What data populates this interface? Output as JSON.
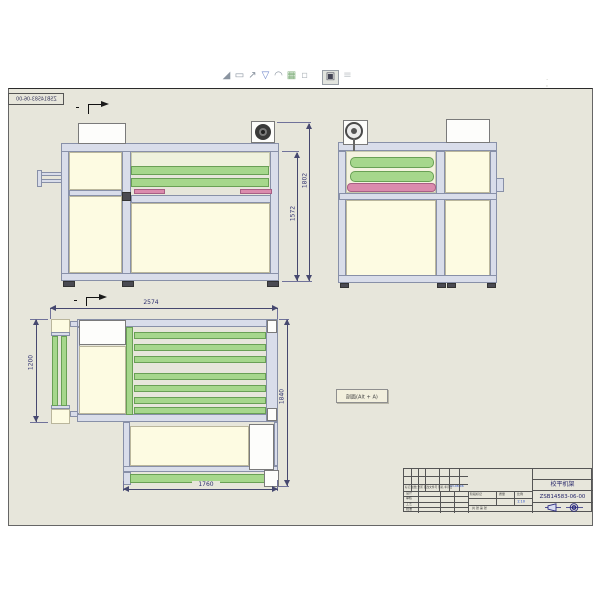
{
  "toolbar": {
    "icons": [
      {
        "name": "sketch-segment-tool",
        "glyph": "◢"
      },
      {
        "name": "note-tool",
        "glyph": "▭"
      },
      {
        "name": "leader-tool",
        "glyph": "↗"
      },
      {
        "name": "datum-tool",
        "glyph": "▽"
      },
      {
        "name": "arc-tool",
        "glyph": "◠"
      },
      {
        "name": "table-tool",
        "glyph": "▦"
      },
      {
        "name": "symbol-tool",
        "glyph": "▫"
      },
      {
        "name": "active-annotation-tool",
        "glyph": "▣"
      },
      {
        "name": "more-tool",
        "glyph": "≡"
      }
    ],
    "ghost_marks": "· ' | ,"
  },
  "sheet": {
    "mirrored_doc_no": "ZSB14583-06-00",
    "section_tooltip_label": "剖面(Alt + A)"
  },
  "dimensions": {
    "front_height_outer": "1802",
    "front_height_inner": "1572",
    "top_width": "2574",
    "top_depth_left": "1200",
    "top_depth_right": "1840",
    "top_width_bottom": "1760"
  },
  "title_block": {
    "part_name": "校平机架",
    "drawing_no": "ZSB14583-06-00",
    "rev_header_line": "标记 处数 分区 更改文件号 签名 年月日",
    "rev_entry": "13-08-06",
    "sign_rows": [
      {
        "label": "设计"
      },
      {
        "label": "审核"
      },
      {
        "label": "工艺"
      },
      {
        "label": "批准"
      }
    ],
    "mid_headers": [
      "阶段标记",
      "质量",
      "比例"
    ],
    "scale_value": "1:10",
    "sheets_note": "共 张 第 张"
  },
  "colors": {
    "sheet_bg": "#E7E6DB",
    "frame_lavender": "#D9DDEA",
    "panel_cream": "#FDFBE2",
    "roller_green": "#A6D78C",
    "pad_pink": "#DB8BAD",
    "dim_navy": "#2D2F6E"
  }
}
